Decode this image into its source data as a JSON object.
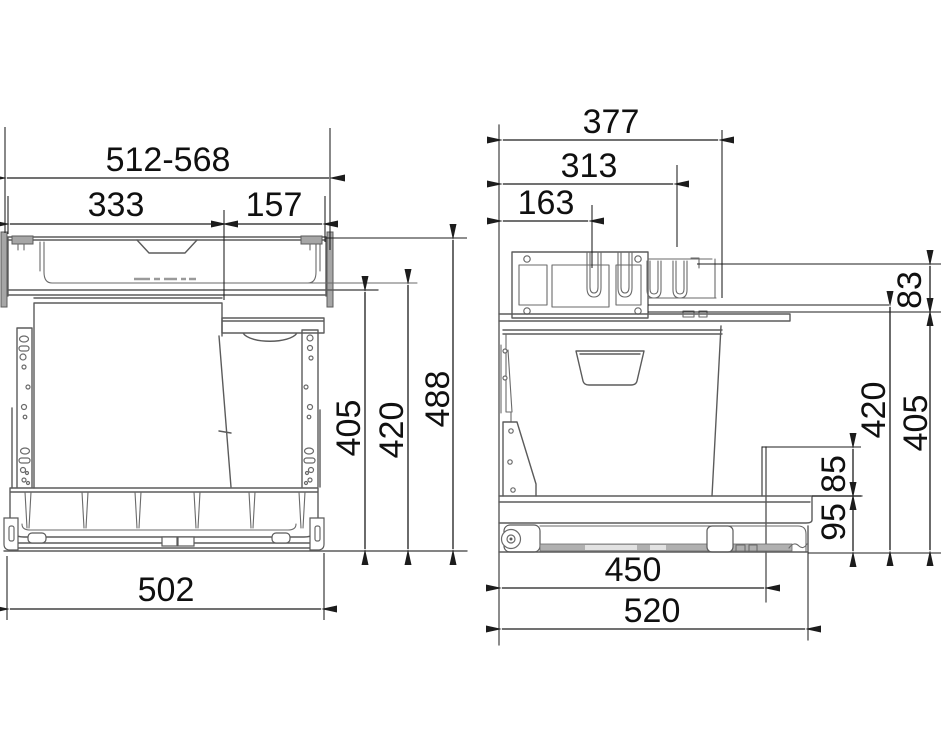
{
  "drawing": {
    "type": "technical-dimension-drawing",
    "subject": "pull-out-waste-bin-unit",
    "colors": {
      "dimension_lines": "#1c1c1c",
      "structure_lines": "#5b5b5b",
      "metal_fill": "#a6a6a6"
    },
    "front_view": {
      "width_range": "512-568",
      "large_compartment_width": "333",
      "small_compartment_width": "157",
      "bin_height": "405",
      "frame_height": "420",
      "total_height": "488",
      "base_width": "502"
    },
    "side_view": {
      "total_depth": "377",
      "rail_depth_mid": "313",
      "rail_depth_front": "163",
      "top_rail_height": "83",
      "frame_height": "420",
      "bin_height": "405",
      "rear_step_height": "85",
      "base_height": "95",
      "slide_depth": "450",
      "base_depth": "520"
    }
  }
}
